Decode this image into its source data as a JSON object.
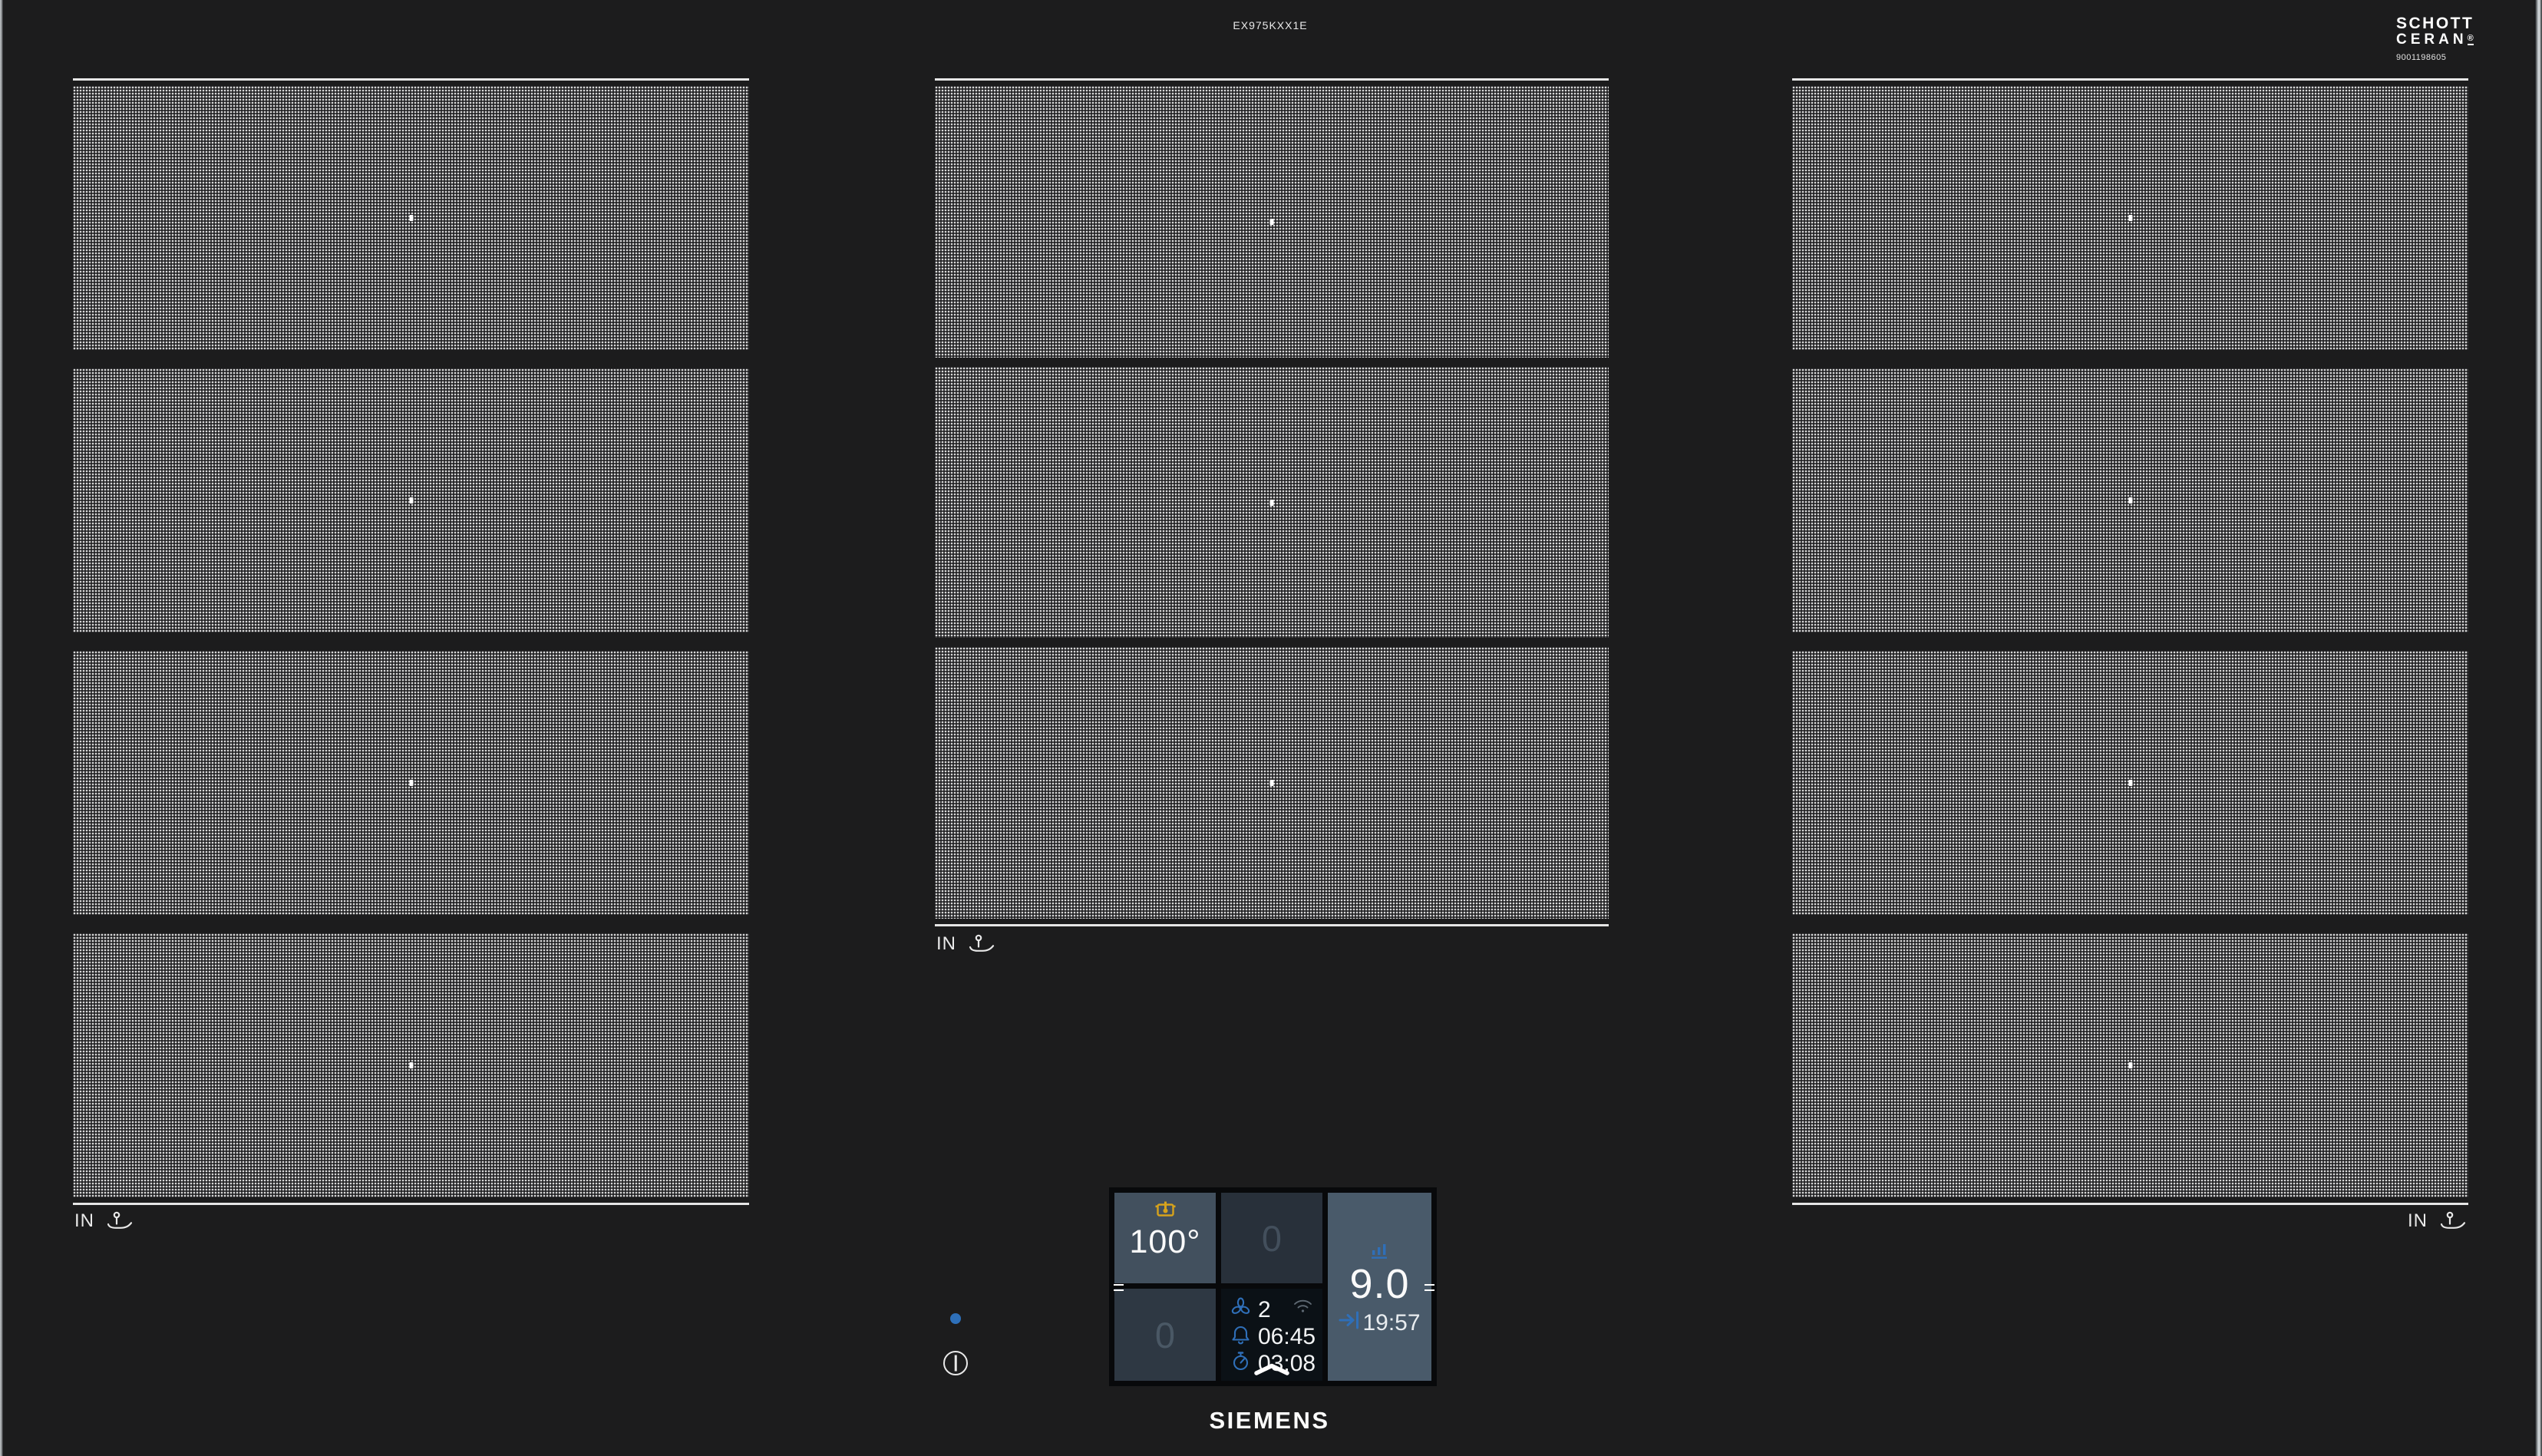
{
  "device": {
    "model": "EX975KXX1E",
    "brand": "SIEMENS",
    "glass_brand_line1": "SCHOTT",
    "glass_brand_line2": "CERAN",
    "glass_brand_reg": "®",
    "glass_serial": "9001198605"
  },
  "zones": {
    "marker_label": "IN",
    "columns": [
      {
        "id": "left",
        "segments": 4
      },
      {
        "id": "center",
        "segments": 3
      },
      {
        "id": "right",
        "segments": 4
      }
    ]
  },
  "control_panel": {
    "temp_tile": {
      "value": "100°",
      "icon": "pot-sensor-icon"
    },
    "zone_tiles": [
      {
        "value": "0"
      },
      {
        "value": "0"
      }
    ],
    "power_tile": {
      "level": "9.0",
      "timer": "19:57",
      "level_icon": "power-level-bars-icon",
      "timer_icon": "time-to-end-icon"
    },
    "status": {
      "fan_level": "2",
      "alarm_time": "06:45",
      "timer": "03:08",
      "fan_icon": "fan-icon",
      "alarm_icon": "bell-icon",
      "timer_icon": "stopwatch-icon",
      "wifi_icon": "wifi-icon"
    }
  },
  "icons": {
    "pan-sensor-icon": "pan with thermometer",
    "pot-sensor-icon": "pot with temperature sensor",
    "power-level-bars-icon": "ascending bars",
    "time-to-end-icon": "arrow to bar",
    "fan-icon": "propeller",
    "bell-icon": "alarm bell",
    "stopwatch-icon": "kitchen timer",
    "wifi-icon": "wifi arcs",
    "expand-chevron-icon": "chevron up",
    "power-icon": "circle with vertical bar"
  },
  "colors": {
    "glass": "#1c1c1d",
    "accent_blue": "#2f6fb8",
    "amber": "#d7a31c",
    "tile_active": "#42505e",
    "tile_power": "#495a6a",
    "tile_inactive_1": "#28303a",
    "tile_inactive_2": "#2e3843",
    "led_blue": "#2e70ba"
  }
}
